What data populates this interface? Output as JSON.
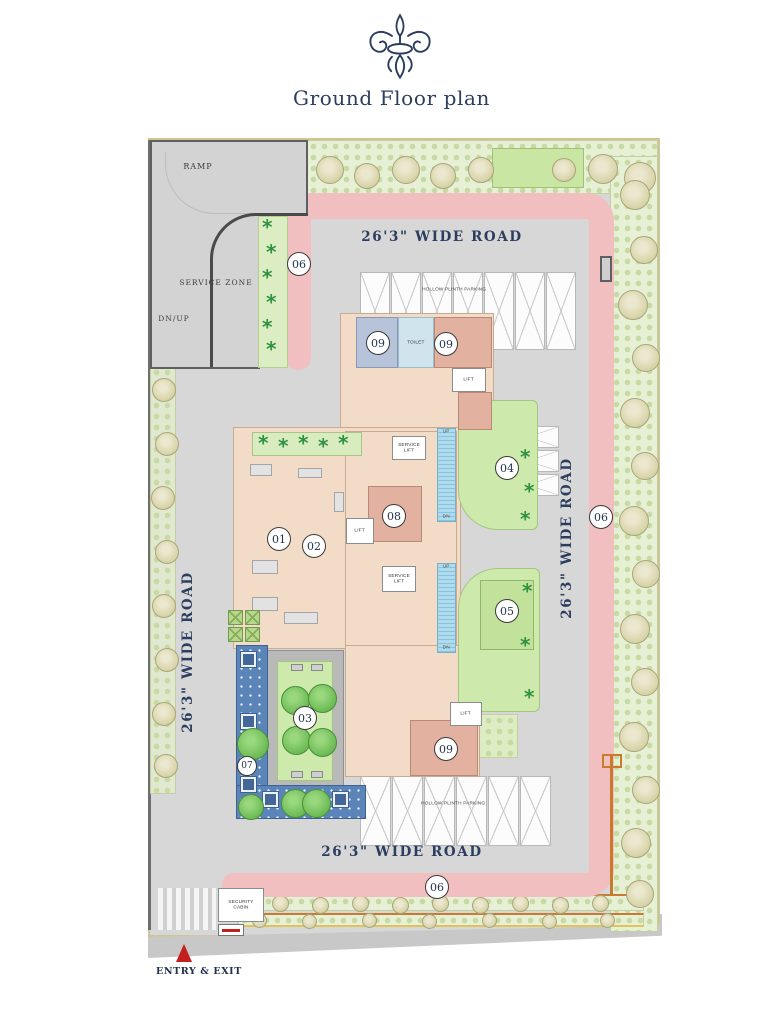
{
  "header": {
    "ornament": "fleur-de-lis",
    "title": "Ground Floor plan"
  },
  "roads": {
    "wide_road": "26'3\" WIDE ROAD"
  },
  "markers": {
    "m01": "01",
    "m02": "02",
    "m03": "03",
    "m04": "04",
    "m05": "05",
    "m06": "06",
    "m07": "07",
    "m08": "08",
    "m09": "09"
  },
  "labels": {
    "ramp": "RAMP",
    "service_zone": "SERVICE ZONE",
    "dn_up": "DN/UP",
    "up": "UP",
    "dn": "DN",
    "toilet": "TOILET",
    "lift": "LIFT",
    "service_lift": "SERVICE LIFT",
    "parking": "HOLLOW PLINTH PARKING",
    "security_cabin": "SECURITY CABIN",
    "entry_exit": "ENTRY & EXIT"
  },
  "colors": {
    "navy": "#2c3e5f",
    "road_gray": "#d7d7d7",
    "path_pink": "#f1bfbf",
    "building_peach": "#f3dcc7",
    "lawn_green": "#cde9ab",
    "deck_blue": "#5b84b8",
    "room_salmon": "#e2b1a0",
    "room_blue": "#b7c3d8",
    "pool_blue": "#aedcee",
    "entry_red": "#c41e1e",
    "boundary_orange": "#c87a2e"
  }
}
